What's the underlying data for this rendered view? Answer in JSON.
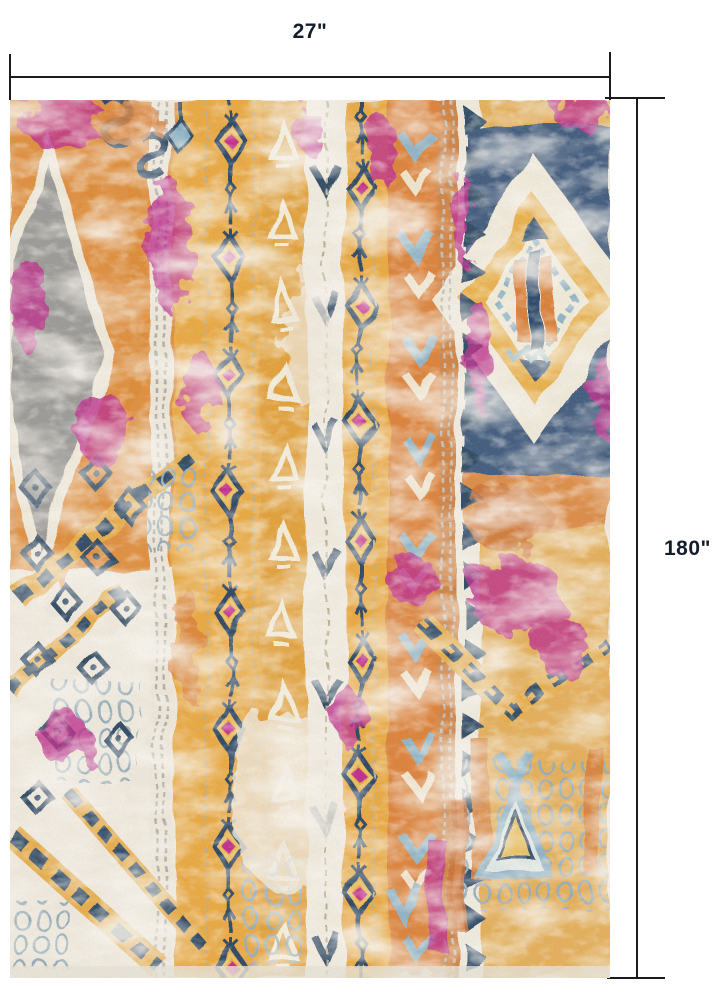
{
  "page": {
    "type": "product dimension diagram",
    "background": "#FFFFFF"
  },
  "dimensions": {
    "width": {
      "label": "27\"",
      "value_inches": 27
    },
    "height": {
      "label": "180\"",
      "value_inches": 180
    }
  },
  "product": {
    "name": "distressed bohemian runner rug",
    "description": "Vintage boho runner with vertical tribal stripes, lantern-diamond chain columns, zigzag sawtooth border, Greek-key chain bands, gray elongated diamond medallion at top left and gold/navy diamond medallions on the right, in orange, gold, cream, navy, magenta, light blue and gray.",
    "palette": {
      "cream": "#EFE8DB",
      "gold": "#E9A840",
      "amber": "#E2A038",
      "orange": "#DC8138",
      "rust": "#CC6F30",
      "navy": "#2C4664",
      "navy_deep": "#24374F",
      "light_blue": "#8FB3C5",
      "magenta": "#BE2E8C",
      "gray": "#9B9995",
      "dimension_line": "#1B1B1B",
      "label_text": "#141E2B"
    }
  }
}
